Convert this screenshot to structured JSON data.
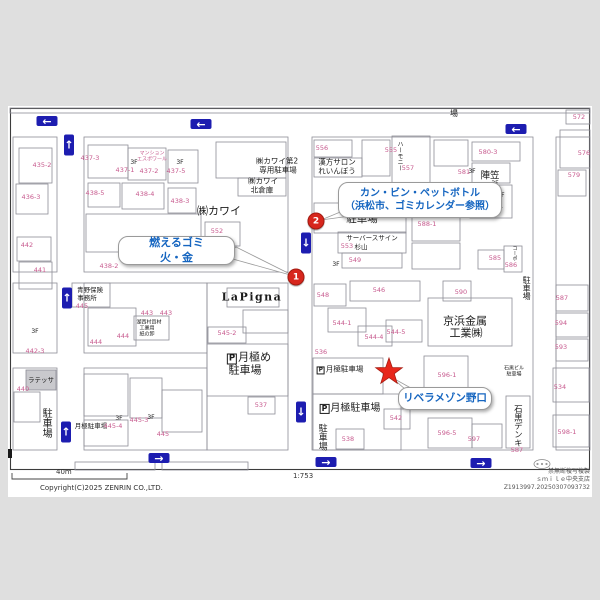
{
  "map": {
    "callouts": [
      {
        "name": "callout-burnable-garbage",
        "lines": [
          "燃えるゴミ",
          "火・金"
        ],
        "x": 118,
        "y": 236,
        "w": 115,
        "h": 27,
        "fs": 11
      },
      {
        "name": "callout-can-bin-pet",
        "lines": [
          "カン・ビン・ペットボトル",
          "（浜松市、ゴミカレンダー参照）"
        ],
        "x": 338,
        "y": 182,
        "w": 162,
        "h": 34,
        "fs": 10
      },
      {
        "name": "callout-libera-maison-noguchi",
        "lines": [
          "リベラメゾン野口"
        ],
        "x": 398,
        "y": 387,
        "w": 92,
        "h": 21,
        "fs": 10.5
      }
    ],
    "markers": [
      {
        "num": "1",
        "x": 296,
        "y": 277
      },
      {
        "num": "2",
        "x": 316,
        "y": 221
      }
    ],
    "arrows": [
      {
        "d": "left",
        "x": 47,
        "y": 121
      },
      {
        "d": "left",
        "x": 201,
        "y": 124
      },
      {
        "d": "left",
        "x": 516,
        "y": 129
      },
      {
        "d": "up",
        "x": 69,
        "y": 145
      },
      {
        "d": "up",
        "x": 67,
        "y": 298
      },
      {
        "d": "up",
        "x": 66,
        "y": 432
      },
      {
        "d": "down",
        "x": 306,
        "y": 243
      },
      {
        "d": "down",
        "x": 301,
        "y": 412
      },
      {
        "d": "right",
        "x": 159,
        "y": 458
      },
      {
        "d": "right",
        "x": 326,
        "y": 462
      },
      {
        "d": "right",
        "x": 481,
        "y": 463
      }
    ],
    "texts": [
      {
        "t": "㈱カワイ",
        "x": 219,
        "y": 211,
        "s": 11
      },
      {
        "t": "㈱カワイ第2",
        "x": 277,
        "y": 161,
        "s": 7.5
      },
      {
        "t": "専用駐車場",
        "x": 278,
        "y": 170,
        "s": 7.5
      },
      {
        "t": "㈱カワイ",
        "x": 263,
        "y": 181,
        "s": 7.5
      },
      {
        "t": "北倉庫",
        "x": 262,
        "y": 190,
        "s": 7.5
      },
      {
        "t": "漢方サロン",
        "x": 337,
        "y": 162,
        "s": 7.5
      },
      {
        "t": "れいんぼう",
        "x": 337,
        "y": 171,
        "s": 7.5
      },
      {
        "t": "駐車場",
        "x": 362,
        "y": 219,
        "s": 10.5
      },
      {
        "t": "サーバースサイン",
        "x": 372,
        "y": 238,
        "s": 6.5
      },
      {
        "t": "杉山",
        "x": 361,
        "y": 247,
        "s": 6.5
      },
      {
        "t": "陣笠",
        "x": 490,
        "y": 176,
        "s": 9.5
      },
      {
        "t": "アルテ",
        "x": 489,
        "y": 199,
        "s": 8.5
      },
      {
        "t": "ライト",
        "x": 491,
        "y": 208,
        "s": 8.5
      },
      {
        "t": "京浜金属",
        "x": 465,
        "y": 321,
        "s": 11
      },
      {
        "t": "工業㈱",
        "x": 466,
        "y": 333,
        "s": 11
      },
      {
        "t": "青野保険",
        "x": 90,
        "y": 290,
        "s": 6.5
      },
      {
        "t": "事務所",
        "x": 87,
        "y": 298,
        "s": 6.5
      },
      {
        "t": "月極め",
        "x": 249,
        "y": 358,
        "s": 11,
        "p": 1
      },
      {
        "t": "駐車場",
        "x": 245,
        "y": 370,
        "s": 11
      },
      {
        "t": "月極駐車場",
        "x": 340,
        "y": 370,
        "s": 7.5,
        "p": 1
      },
      {
        "t": "月極駐車場",
        "x": 350,
        "y": 409,
        "s": 10,
        "p": 1
      },
      {
        "t": "月極駐車場",
        "x": 91,
        "y": 426,
        "s": 6.5
      },
      {
        "t": "駐車場",
        "x": 45,
        "y": 423,
        "s": 10,
        "v": 1
      },
      {
        "t": "駐車場",
        "x": 321,
        "y": 437,
        "s": 9,
        "v": 1
      },
      {
        "t": "駐車場",
        "x": 526,
        "y": 288,
        "s": 8,
        "v": 1
      },
      {
        "t": "石黒デンキ",
        "x": 517,
        "y": 426,
        "s": 8.5,
        "v": 1
      },
      {
        "t": "場",
        "x": 454,
        "y": 114,
        "s": 8
      },
      {
        "t": "ラテッサ",
        "x": 41,
        "y": 380,
        "s": 6.5
      },
      {
        "t": "湖西村資材",
        "x": 149,
        "y": 323,
        "s": 5
      },
      {
        "t": "工業用",
        "x": 147,
        "y": 329,
        "s": 5
      },
      {
        "t": "紙の卸",
        "x": 147,
        "y": 335,
        "s": 5
      },
      {
        "t": "LaPigna",
        "x": 252,
        "y": 297,
        "s": 11,
        "cls": "lapigna"
      },
      {
        "t": "3F",
        "x": 134,
        "y": 163,
        "s": 6
      },
      {
        "t": "3F",
        "x": 180,
        "y": 163,
        "s": 6
      },
      {
        "t": "3F",
        "x": 336,
        "y": 265,
        "s": 6
      },
      {
        "t": "3F",
        "x": 35,
        "y": 332,
        "s": 6
      },
      {
        "t": "3F",
        "x": 119,
        "y": 419,
        "s": 6
      },
      {
        "t": "3F",
        "x": 151,
        "y": 418,
        "s": 6
      },
      {
        "t": "3F",
        "x": 472,
        "y": 172,
        "s": 6
      },
      {
        "t": "3F",
        "x": 495,
        "y": 184,
        "s": 6
      },
      {
        "t": "3F",
        "x": 501,
        "y": 196,
        "s": 6
      },
      {
        "t": "ハーモニー",
        "x": 399,
        "y": 156,
        "s": 6,
        "v": 1
      },
      {
        "t": "マンション",
        "x": 152,
        "y": 154,
        "s": 5,
        "c": "m"
      },
      {
        "t": "エスポワール",
        "x": 152,
        "y": 160,
        "s": 5,
        "c": "m"
      },
      {
        "t": "石黒ビル",
        "x": 514,
        "y": 369,
        "s": 5
      },
      {
        "t": "駐車場",
        "x": 514,
        "y": 375,
        "s": 5
      },
      {
        "t": "コーポ",
        "x": 514,
        "y": 253,
        "s": 5,
        "v": 1
      }
    ],
    "parcels": [
      {
        "t": "435-2",
        "x": 42,
        "y": 165
      },
      {
        "t": "436-3",
        "x": 31,
        "y": 197
      },
      {
        "t": "437-3",
        "x": 90,
        "y": 158
      },
      {
        "t": "437-1",
        "x": 125,
        "y": 170
      },
      {
        "t": "437-2",
        "x": 149,
        "y": 171
      },
      {
        "t": "437-5",
        "x": 176,
        "y": 171
      },
      {
        "t": "438-5",
        "x": 95,
        "y": 193
      },
      {
        "t": "438-4",
        "x": 145,
        "y": 194
      },
      {
        "t": "438-3",
        "x": 180,
        "y": 201
      },
      {
        "t": "552",
        "x": 217,
        "y": 231
      },
      {
        "t": "442",
        "x": 27,
        "y": 245
      },
      {
        "t": "441",
        "x": 40,
        "y": 270
      },
      {
        "t": "438-2",
        "x": 109,
        "y": 266
      },
      {
        "t": "445",
        "x": 82,
        "y": 306
      },
      {
        "t": "443",
        "x": 147,
        "y": 313
      },
      {
        "t": "443",
        "x": 166,
        "y": 313
      },
      {
        "t": "444",
        "x": 96,
        "y": 342
      },
      {
        "t": "444",
        "x": 123,
        "y": 336
      },
      {
        "t": "442-3",
        "x": 35,
        "y": 351
      },
      {
        "t": "440",
        "x": 23,
        "y": 389
      },
      {
        "t": "445-4",
        "x": 113,
        "y": 426
      },
      {
        "t": "445-3",
        "x": 139,
        "y": 420
      },
      {
        "t": "445",
        "x": 163,
        "y": 434
      },
      {
        "t": "545-2",
        "x": 227,
        "y": 333
      },
      {
        "t": "537",
        "x": 261,
        "y": 405
      },
      {
        "t": "556",
        "x": 322,
        "y": 148
      },
      {
        "t": "555",
        "x": 391,
        "y": 150
      },
      {
        "t": "557",
        "x": 408,
        "y": 168
      },
      {
        "t": "553",
        "x": 347,
        "y": 246
      },
      {
        "t": "549",
        "x": 355,
        "y": 260
      },
      {
        "t": "548",
        "x": 323,
        "y": 295
      },
      {
        "t": "546",
        "x": 379,
        "y": 290
      },
      {
        "t": "544-1",
        "x": 342,
        "y": 323
      },
      {
        "t": "544-4",
        "x": 374,
        "y": 337
      },
      {
        "t": "544-5",
        "x": 396,
        "y": 332
      },
      {
        "t": "536",
        "x": 321,
        "y": 352
      },
      {
        "t": "542",
        "x": 396,
        "y": 418
      },
      {
        "t": "538",
        "x": 348,
        "y": 439
      },
      {
        "t": "596-1",
        "x": 447,
        "y": 375
      },
      {
        "t": "596-5",
        "x": 447,
        "y": 433
      },
      {
        "t": "597",
        "x": 474,
        "y": 439
      },
      {
        "t": "588-1",
        "x": 427,
        "y": 224
      },
      {
        "t": "581",
        "x": 464,
        "y": 172
      },
      {
        "t": "580-3",
        "x": 488,
        "y": 152
      },
      {
        "t": "580-2",
        "x": 484,
        "y": 185
      },
      {
        "t": "572",
        "x": 579,
        "y": 117
      },
      {
        "t": "576",
        "x": 584,
        "y": 153
      },
      {
        "t": "579",
        "x": 574,
        "y": 175
      },
      {
        "t": "585",
        "x": 495,
        "y": 258
      },
      {
        "t": "586",
        "x": 511,
        "y": 265
      },
      {
        "t": "590",
        "x": 461,
        "y": 292
      },
      {
        "t": "587",
        "x": 562,
        "y": 298
      },
      {
        "t": "594",
        "x": 561,
        "y": 323
      },
      {
        "t": "593",
        "x": 561,
        "y": 347
      },
      {
        "t": "534",
        "x": 560,
        "y": 387
      },
      {
        "t": "598-1",
        "x": 567,
        "y": 432
      },
      {
        "t": "587",
        "x": 517,
        "y": 450
      }
    ]
  },
  "footer": {
    "scale": "40m",
    "ratio": "1:753",
    "copyright": "Copyright(C)2025 ZENRIN CO.,LTD.",
    "notice": "禁無断複写複製",
    "branch": "ｓｍｉｌｅ中央支店",
    "code": "Z1913997.20250307093732"
  },
  "colors": {
    "parcel_number": "#c75a8e",
    "arrow_blue": "#1d1db0",
    "marker_red": "#d7261d",
    "callout_blue": "#1565c0",
    "page_gray": "#dfdfdf"
  }
}
